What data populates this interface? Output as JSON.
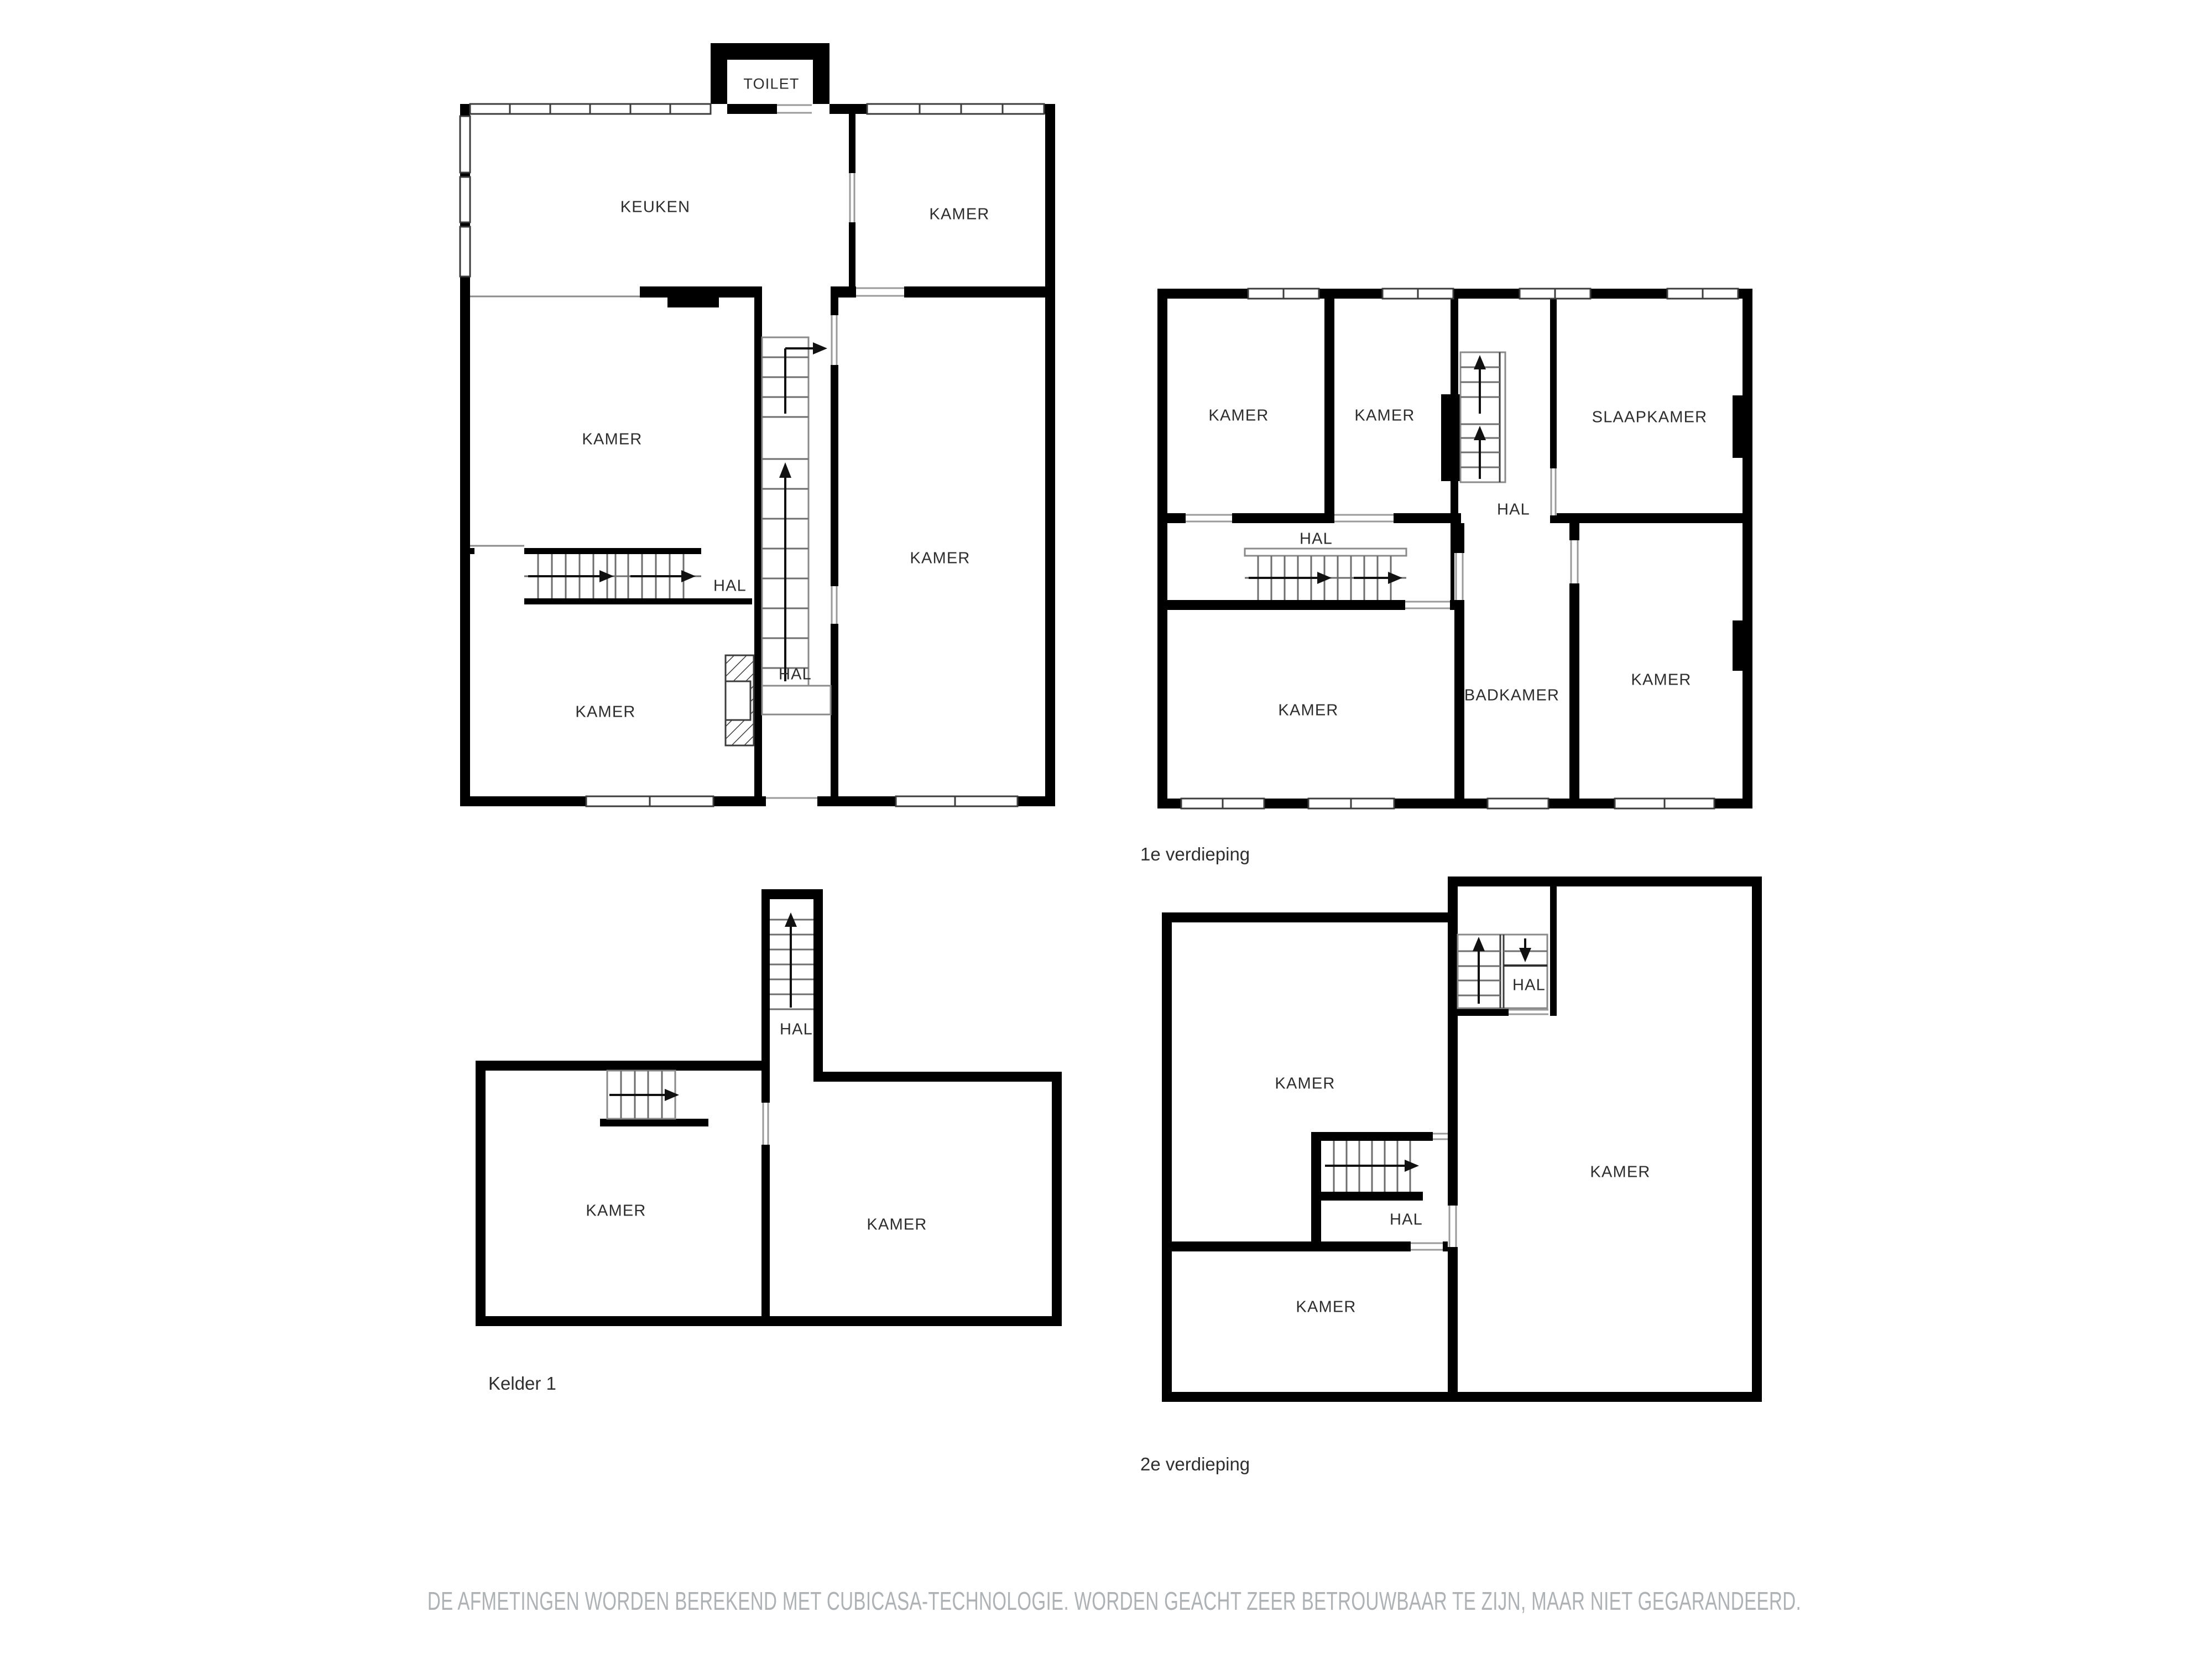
{
  "floors": {
    "ground": {
      "rooms": [
        "TOILET",
        "KEUKEN",
        "KAMER",
        "KAMER",
        "KAMER",
        "HAL",
        "HAL",
        "KAMER"
      ]
    },
    "first": {
      "title": "1e verdieping",
      "rooms": [
        "KAMER",
        "KAMER",
        "SLAAPKAMER",
        "HAL",
        "HAL",
        "KAMER",
        "BADKAMER",
        "KAMER"
      ]
    },
    "basement": {
      "title": "Kelder 1",
      "rooms": [
        "HAL",
        "KAMER",
        "KAMER"
      ]
    },
    "second": {
      "title": "2e verdieping",
      "rooms": [
        "HAL",
        "KAMER",
        "KAMER",
        "HAL",
        "KAMER"
      ]
    }
  },
  "disclaimer": "DE AFMETINGEN WORDEN BEREKEND MET CUBICASA-TECHNOLOGIE. WORDEN GEACHT ZEER BETROUWBAAR TE ZIJN, MAAR NIET GEGARANDEERD.",
  "colors": {
    "wall": "#000000",
    "thin_line": "#8a8a8a",
    "tread_line": "#6e6e6e",
    "label_text": "#2d2d2d",
    "disclaimer_text": "#aeb2b4"
  }
}
